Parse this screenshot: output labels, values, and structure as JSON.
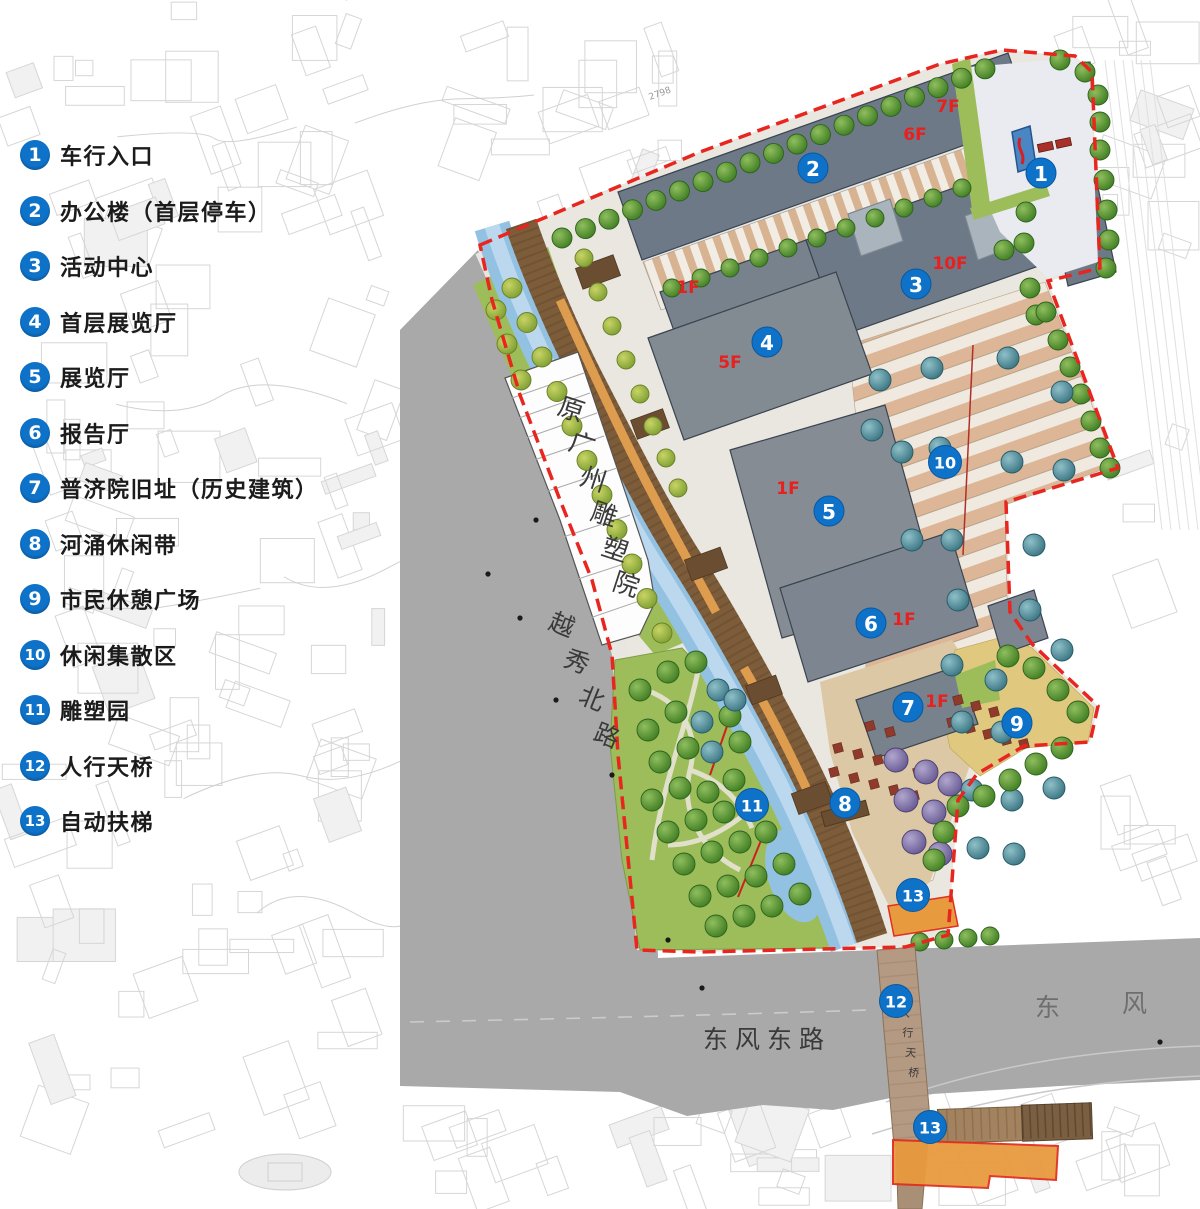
{
  "legend": {
    "items": [
      {
        "num": "1",
        "label": "车行入口"
      },
      {
        "num": "2",
        "label": "办公楼（首层停车）"
      },
      {
        "num": "3",
        "label": "活动中心"
      },
      {
        "num": "4",
        "label": "首层展览厅"
      },
      {
        "num": "5",
        "label": "展览厅"
      },
      {
        "num": "6",
        "label": "报告厅"
      },
      {
        "num": "7",
        "label": "普济院旧址（历史建筑）"
      },
      {
        "num": "8",
        "label": "河涌休闲带"
      },
      {
        "num": "9",
        "label": "市民休憩广场"
      },
      {
        "num": "10",
        "label": "休闲集散区"
      },
      {
        "num": "11",
        "label": "雕塑园"
      },
      {
        "num": "12",
        "label": "人行天桥"
      },
      {
        "num": "13",
        "label": "自动扶梯"
      }
    ]
  },
  "map": {
    "markers": [
      {
        "num": "1",
        "x": 1041,
        "y": 173
      },
      {
        "num": "2",
        "x": 813,
        "y": 168
      },
      {
        "num": "3",
        "x": 916,
        "y": 284
      },
      {
        "num": "4",
        "x": 767,
        "y": 342
      },
      {
        "num": "5",
        "x": 829,
        "y": 511
      },
      {
        "num": "6",
        "x": 871,
        "y": 623
      },
      {
        "num": "7",
        "x": 908,
        "y": 707
      },
      {
        "num": "8",
        "x": 845,
        "y": 803
      },
      {
        "num": "9",
        "x": 1017,
        "y": 723
      },
      {
        "num": "10",
        "x": 945,
        "y": 462
      },
      {
        "num": "11",
        "x": 752,
        "y": 805
      },
      {
        "num": "12",
        "x": 896,
        "y": 1001
      },
      {
        "num": "13",
        "x": 913,
        "y": 895
      },
      {
        "num": "13",
        "x": 930,
        "y": 1127
      }
    ],
    "floor_labels": [
      {
        "text": "7F",
        "x": 948,
        "y": 112
      },
      {
        "text": "6F",
        "x": 915,
        "y": 140
      },
      {
        "text": "10F",
        "x": 950,
        "y": 269
      },
      {
        "text": "1F",
        "x": 688,
        "y": 293
      },
      {
        "text": "5F",
        "x": 730,
        "y": 368
      },
      {
        "text": "1F",
        "x": 788,
        "y": 494
      },
      {
        "text": "1F",
        "x": 904,
        "y": 625
      },
      {
        "text": "1F",
        "x": 937,
        "y": 707
      }
    ],
    "labels": {
      "sculpture_institute": "原广州雕塑院",
      "yuexiu_north_road": "越秀北路",
      "dongfeng_east_road": "东风东路",
      "dongfeng_right_1": "东",
      "dongfeng_right_2": "风",
      "pedestrian_bridge": "人行天桥",
      "annotation_2798": "2798"
    },
    "colors": {
      "marker_blue": "#0e72c8",
      "floor_label_red": "#e8201f",
      "boundary_red": "#e8251f",
      "building_gray": "#707b85",
      "road_gray": "#a9a9a9",
      "canal_blue": "#93c1e2",
      "lawn_green": "#9dbd5b",
      "boardwalk_brown": "#7d5c3a",
      "terrace_tan": "#dcb696",
      "plaza_yellow": "#e0c97e"
    }
  }
}
